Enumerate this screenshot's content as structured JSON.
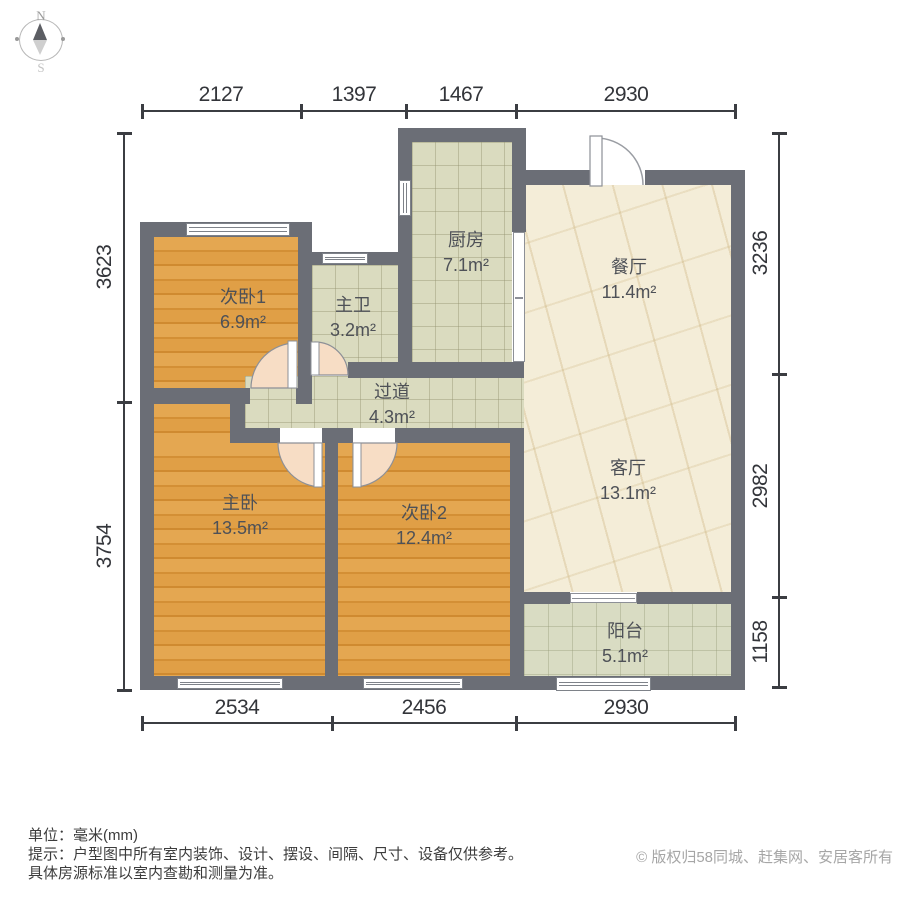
{
  "compass": {
    "north": "N",
    "south": "S"
  },
  "rooms": [
    {
      "id": "bedroom1",
      "name": "次卧1",
      "area": "6.9m²"
    },
    {
      "id": "master-bath",
      "name": "主卫",
      "area": "3.2m²"
    },
    {
      "id": "kitchen",
      "name": "厨房",
      "area": "7.1m²"
    },
    {
      "id": "dining-room",
      "name": "餐厅",
      "area": "11.4m²"
    },
    {
      "id": "hallway",
      "name": "过道",
      "area": "4.3m²"
    },
    {
      "id": "master-bedroom",
      "name": "主卧",
      "area": "13.5m²"
    },
    {
      "id": "bedroom2",
      "name": "次卧2",
      "area": "12.4m²"
    },
    {
      "id": "living-room",
      "name": "客厅",
      "area": "13.1m²"
    },
    {
      "id": "balcony",
      "name": "阳台",
      "area": "5.1m²"
    }
  ],
  "dims": {
    "top": [
      "2127",
      "1397",
      "1467",
      "2930"
    ],
    "bottom": [
      "2534",
      "2456",
      "2930"
    ],
    "left": [
      "3623",
      "3754"
    ],
    "right": [
      "3236",
      "2982",
      "1158"
    ]
  },
  "footer": {
    "unit_line": "单位：毫米(mm)",
    "tip_line1": "提示：户型图中所有室内装饰、设计、摆设、间隔、尺寸、设备仅供参考。",
    "tip_line2": "具体房源标准以室内查勘和测量为准。",
    "copyright": "© 版权归58同城、赶集网、安居客所有"
  },
  "colors": {
    "wall": "#6b6e76",
    "wood_floor": "#dfa04c",
    "tile_floor": "#dadbbf",
    "marble_floor": "#f4edd8",
    "balcony_floor": "#d9dcc3",
    "door_leaf": "#f7ddc5",
    "dimension_text": "#33353a"
  }
}
